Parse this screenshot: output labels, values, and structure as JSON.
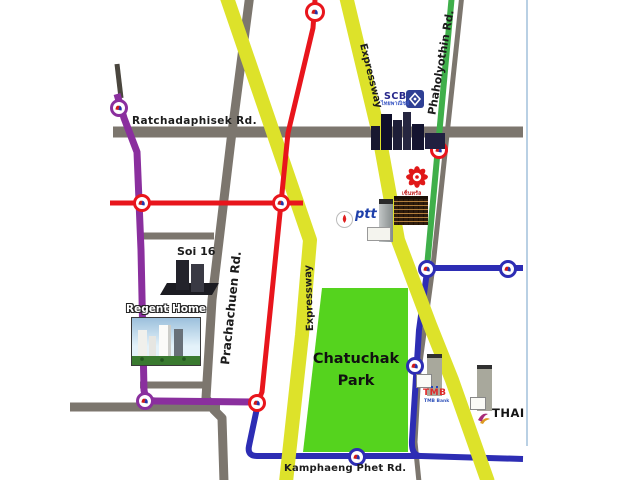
{
  "labels": {
    "ratchadaphisek": "Ratchadaphisek Rd.",
    "soi16": "Soi 16",
    "prachachuen": "Prachachuen Rd.",
    "expressway_upper": "Expressway",
    "expressway_lower": "Expressway",
    "phaholyothin": "Phaholyothin Rd.",
    "kamphaeng_phet": "Kamphaeng Phet Rd.",
    "park_line1": "Chatuchak",
    "park_line2": "Park",
    "regent_home": "Regent Home"
  },
  "landmarks": {
    "scb": {
      "name": "SCB",
      "thai": "ไทยพาณิชย์"
    },
    "ptt": {
      "name": "ptt"
    },
    "tmb": {
      "name": "TMB",
      "sub": "TMB Bank"
    },
    "thai_airways": {
      "name": "THAI"
    },
    "red_flower": {
      "thai": "เซ็นทรัล"
    }
  },
  "colors": {
    "expressway_yellow": "#dde22a",
    "purple_line": "#8a2f9e",
    "blue_line": "#2d2db4",
    "red_line": "#e8151c",
    "green_road": "#3faf4a",
    "road_gray": "#7c766e",
    "park_green": "#55d31e"
  }
}
